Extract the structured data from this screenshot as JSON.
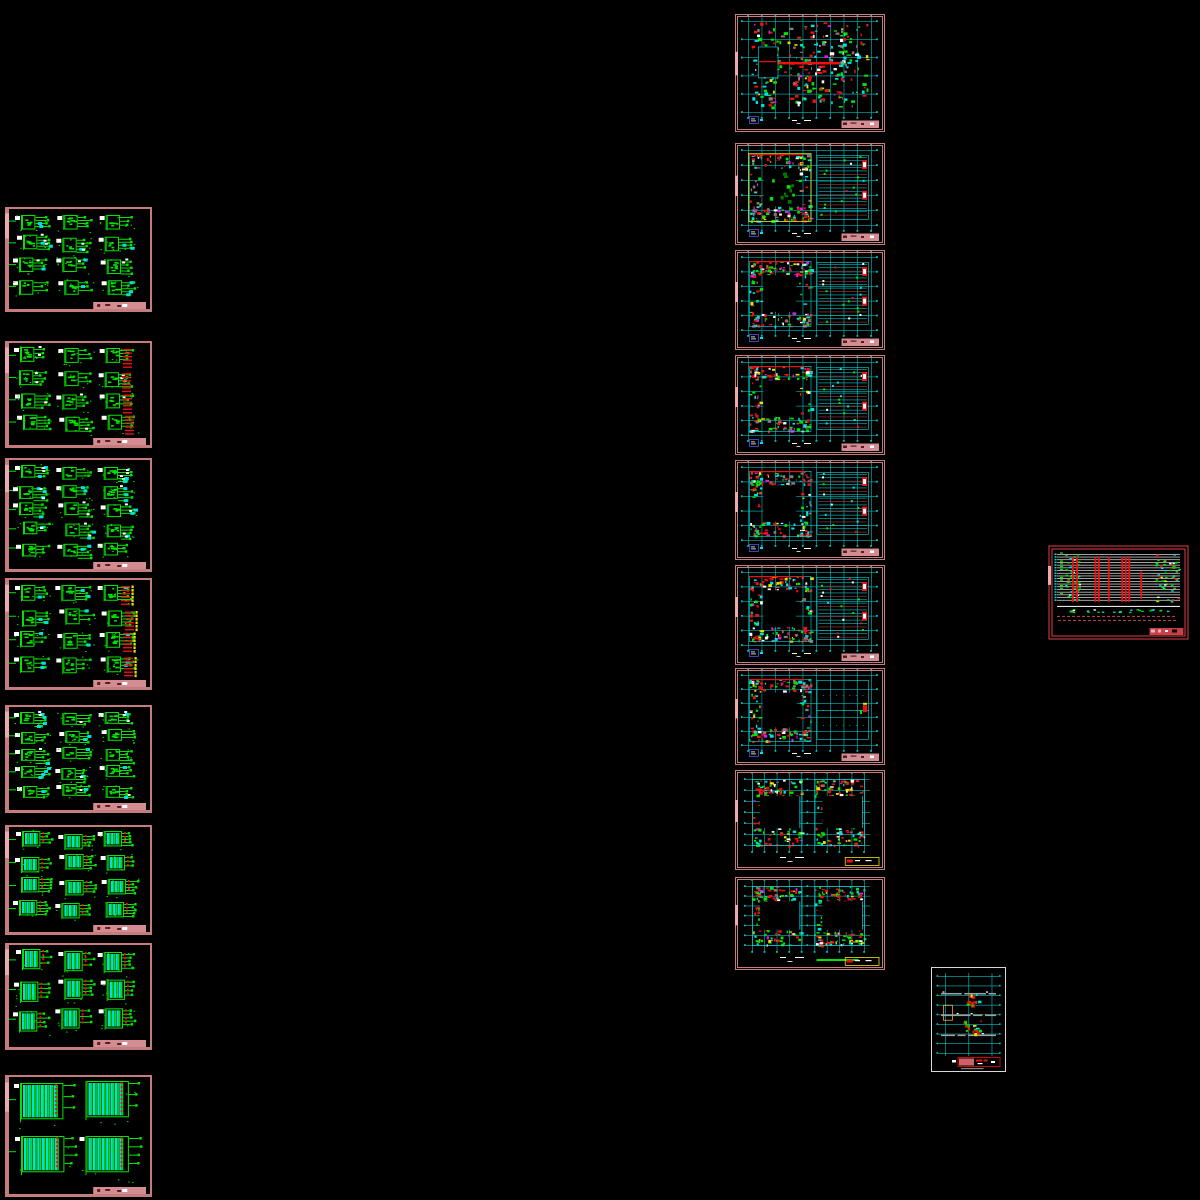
{
  "canvas": {
    "width": 1200,
    "height": 1200,
    "background": "#000000"
  },
  "palette": {
    "background": "#000000",
    "border_rose": "#c47c7c",
    "border_light": "#ecaab0",
    "title_pink": "#d28c92",
    "green": "#00e400",
    "cyan": "#00e0e0",
    "red": "#f01010",
    "yellow": "#f0e000",
    "magenta": "#e818e8",
    "white": "#ffffff",
    "frame_red": "#e04048",
    "frame_white": "#d8d8d8",
    "legend_blue": "#4858e8",
    "orange": "#f0a048"
  },
  "sheets": [
    {
      "name": "electrical-schematic-01",
      "type": "schematic",
      "x": 5,
      "y": 207,
      "w": 147,
      "h": 105,
      "seed": 11,
      "opts": {
        "cols": 3,
        "rows": 4,
        "cyan": true,
        "white": true
      }
    },
    {
      "name": "electrical-schematic-02",
      "type": "schematic",
      "x": 5,
      "y": 341,
      "w": 147,
      "h": 107,
      "seed": 12,
      "opts": {
        "cols": 3,
        "rows": 4,
        "white": true,
        "redRight": true
      }
    },
    {
      "name": "electrical-schematic-03",
      "type": "schematic",
      "x": 5,
      "y": 458,
      "w": 147,
      "h": 114,
      "seed": 13,
      "opts": {
        "cols": 3,
        "rows": 5,
        "cyan": true,
        "white": true
      }
    },
    {
      "name": "electrical-schematic-04",
      "type": "schematic",
      "x": 5,
      "y": 578,
      "w": 147,
      "h": 112,
      "seed": 14,
      "opts": {
        "cols": 3,
        "rows": 4,
        "cyan": true,
        "redRight": true,
        "yellowRight": true
      }
    },
    {
      "name": "electrical-schematic-05",
      "type": "schematic",
      "x": 5,
      "y": 705,
      "w": 147,
      "h": 108,
      "seed": 15,
      "opts": {
        "cols": 3,
        "rows": 5,
        "cyan": true,
        "white": true
      }
    },
    {
      "name": "electrical-schematic-06",
      "type": "schematic",
      "x": 5,
      "y": 825,
      "w": 147,
      "h": 110,
      "seed": 16,
      "opts": {
        "cols": 3,
        "rows": 4,
        "cyanCols": true,
        "redDash": true,
        "boxScale": 0.45
      }
    },
    {
      "name": "electrical-schematic-07",
      "type": "schematic",
      "x": 5,
      "y": 943,
      "w": 147,
      "h": 107,
      "seed": 17,
      "opts": {
        "cols": 3,
        "rows": 3,
        "cyanCols": true,
        "redDash": true,
        "boxScale": 0.45
      }
    },
    {
      "name": "electrical-schematic-08",
      "type": "schematic",
      "x": 5,
      "y": 1075,
      "w": 147,
      "h": 122,
      "seed": 18,
      "opts": {
        "cols": 2,
        "rows": 2,
        "cyanCols": true,
        "redDash": true,
        "bigBox": true,
        "boxScale": 0.72
      }
    },
    {
      "name": "floor-plan-01",
      "type": "plan",
      "x": 735,
      "y": 14,
      "w": 150,
      "h": 118,
      "seed": 21,
      "opts": {
        "variant": "dense"
      }
    },
    {
      "name": "floor-plan-02",
      "type": "plan",
      "x": 735,
      "y": 143,
      "w": 150,
      "h": 102,
      "seed": 22,
      "opts": {
        "variant": "garden"
      }
    },
    {
      "name": "floor-plan-03",
      "type": "plan",
      "x": 735,
      "y": 250,
      "w": 150,
      "h": 100,
      "seed": 23,
      "opts": {
        "variant": "courtyard"
      }
    },
    {
      "name": "floor-plan-04",
      "type": "plan",
      "x": 735,
      "y": 355,
      "w": 150,
      "h": 100,
      "seed": 24,
      "opts": {
        "variant": "courtyard"
      }
    },
    {
      "name": "floor-plan-05",
      "type": "plan",
      "x": 735,
      "y": 460,
      "w": 150,
      "h": 100,
      "seed": 25,
      "opts": {
        "variant": "courtyard"
      }
    },
    {
      "name": "floor-plan-06",
      "type": "plan",
      "x": 735,
      "y": 565,
      "w": 150,
      "h": 100,
      "seed": 26,
      "opts": {
        "variant": "courtyard"
      }
    },
    {
      "name": "floor-plan-07",
      "type": "plan",
      "x": 735,
      "y": 668,
      "w": 150,
      "h": 97,
      "seed": 27,
      "opts": {
        "variant": "roof"
      }
    },
    {
      "name": "floor-plan-08",
      "type": "twin",
      "x": 735,
      "y": 770,
      "w": 150,
      "h": 100,
      "seed": 28,
      "opts": {}
    },
    {
      "name": "floor-plan-09",
      "type": "twin",
      "x": 735,
      "y": 877,
      "w": 150,
      "h": 93,
      "seed": 29,
      "opts": {
        "greenBar": true
      }
    },
    {
      "name": "system-riser-diagram",
      "type": "riser",
      "x": 1048,
      "y": 545,
      "w": 141,
      "h": 95,
      "seed": 31,
      "opts": {}
    },
    {
      "name": "detail-floor-plan",
      "type": "portrait",
      "x": 931,
      "y": 967,
      "w": 75,
      "h": 105,
      "seed": 32,
      "opts": {}
    }
  ]
}
